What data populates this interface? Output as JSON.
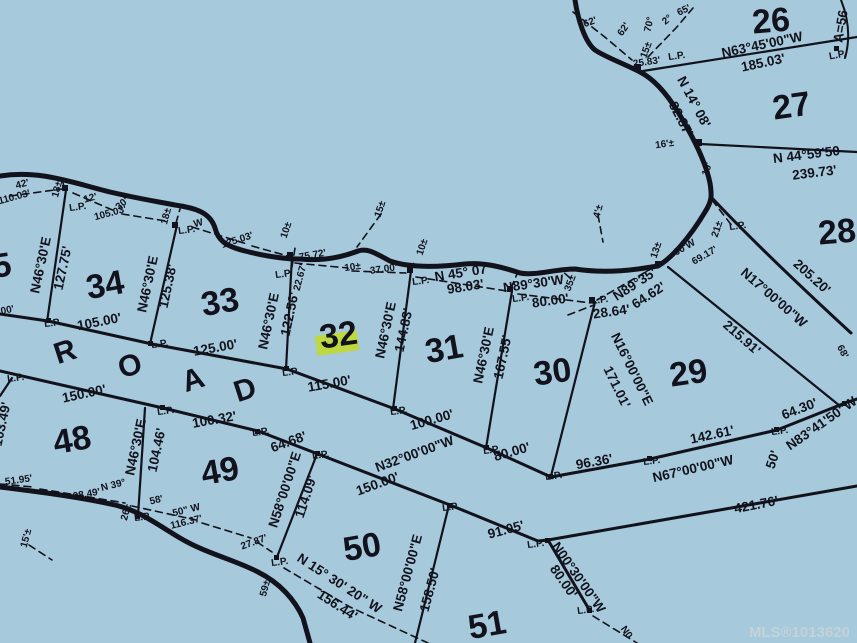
{
  "watermark": "MLS®1013620",
  "colors": {
    "background": "#a6c9db",
    "ink": "#12121c",
    "highlight": "#c2d930",
    "watermark": "#c9d4da"
  },
  "road": {
    "letters": [
      "R",
      "O",
      "A",
      "D"
    ]
  },
  "lots": {
    "l26": "26",
    "l27": "27",
    "l28": "28",
    "l29": "29",
    "l30": "30",
    "l31": "31",
    "l32": "32",
    "l33": "33",
    "l34": "34",
    "l35": "35",
    "l48": "48",
    "l49": "49",
    "l50": "50",
    "l51": "51"
  },
  "dims": {
    "n6345": "N63°45'00\"W",
    "d18503": "185.03'",
    "n445950": "N 44°59'50",
    "d23973": "239.73'",
    "a56": "A=56",
    "n1408": "N 14° 08'",
    "d8287": "82.87'",
    "d2583": "25.83'",
    "n4507": "N 45° 07'",
    "d9803": "98.03'",
    "n8930w": "N89°30'W",
    "d8000": "80.00'",
    "n8935": "N89°35'",
    "d6462": "64.62'",
    "d2864": "28.64'",
    "d6917": "69.17'",
    "p00w": "00'W",
    "n16e": "N16°00'00\"E",
    "d17101": "171.01'",
    "n17w": "N17°00'00\"W",
    "d21591": "215.91'",
    "d20520": "205.20'",
    "d68": "68'",
    "n4630e": "N46°30'E",
    "d12775": "127.75'",
    "d12538": "125.38'",
    "d12256": "122.56'",
    "d2267": "22.67'",
    "d14483": "144.83'",
    "d16755": "167.55'",
    "d10446": "104.46'",
    "d10500": "105.00'",
    "d12500": "125.00'",
    "d11500": "115.00'",
    "d10000": "100.00'",
    "d9636": "96.36'",
    "d14261": "142.61'",
    "d6430": "64.30'",
    "n834150": "N83°41'50\"W",
    "n67w": "N67°00'00\"W",
    "d50": "50'",
    "d42176": "421.76'",
    "d15000": "150.00'",
    "d10032": "100.32'",
    "d10349": "103.49'",
    "d6468": "64.68'",
    "d11409": "114.09'",
    "n32w": "N32°00'00\"W",
    "d9105": "91.05'",
    "d15850": "158.50'",
    "n58e": "N58°00'00\"E",
    "n0030w": "N00°30'00\"W",
    "d5195": "51.95'",
    "d9849": "98.49'",
    "n39": "N 39°",
    "d58m": "58'",
    "d50w": "50\" W",
    "d11637": "116.37'",
    "d2787": "27.87'",
    "n153020": "N 15° 30' 20\" W",
    "d15644": "156.44'",
    "n0": "N0",
    "d4200": "42'",
    "d11003": "110.03'",
    "d12": "12'",
    "d10503": "105.03'",
    "d30": "30'",
    "w": "W",
    "d12503": "125.03'",
    "d7572": "75.72'",
    "d3700": "37.00'",
    "d00": "00'"
  },
  "marks": {
    "lp": "L.P.",
    "pm10": "10±",
    "pm15": "15±",
    "pm18": "18±",
    "pm35": "35±",
    "pm13": "13±",
    "pm21": "21±",
    "pm26": "26±",
    "pm59": "59±",
    "pm15f": "15'±",
    "pm16f": "16'±",
    "pm4": "4'±",
    "d62": "62'",
    "d70": "70°",
    "d2": "2°",
    "d65": "65'",
    "d10f": "10'"
  }
}
